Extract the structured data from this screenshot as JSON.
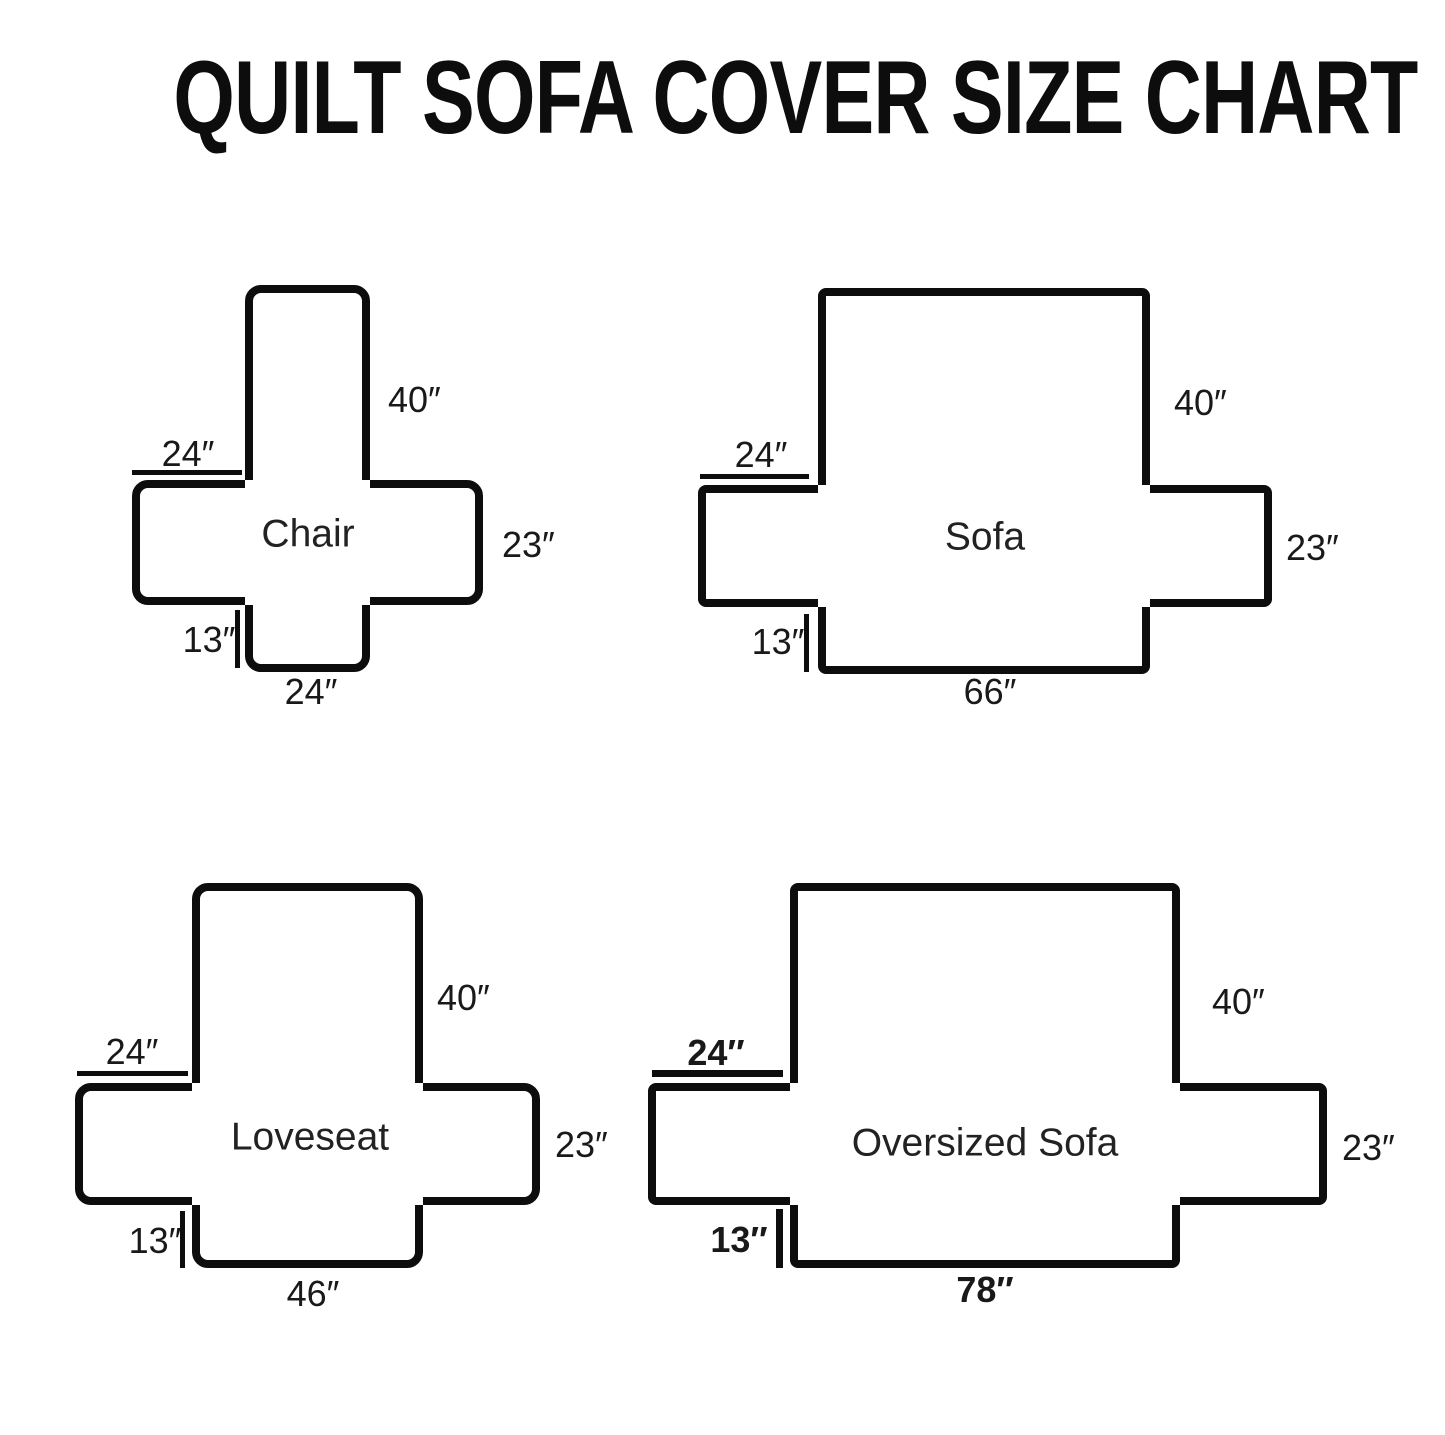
{
  "title": "QUILT SOFA COVER SIZE CHART",
  "diagrams": [
    {
      "name": "Chair",
      "measurements": {
        "back_height": "40″",
        "arm_width": "24″",
        "side_height": "23″",
        "skirt_height": "13″",
        "seat_width": "24″"
      }
    },
    {
      "name": "Sofa",
      "measurements": {
        "back_height": "40″",
        "arm_width": "24″",
        "side_height": "23″",
        "skirt_height": "13″",
        "seat_width": "66″"
      }
    },
    {
      "name": "Loveseat",
      "measurements": {
        "back_height": "40″",
        "arm_width": "24″",
        "side_height": "23″",
        "skirt_height": "13″",
        "seat_width": "46″"
      }
    },
    {
      "name": "Oversized Sofa",
      "measurements": {
        "back_height": "40″",
        "arm_width": "24″",
        "side_height": "23″",
        "skirt_height": "13″",
        "seat_width": "78″"
      }
    }
  ]
}
